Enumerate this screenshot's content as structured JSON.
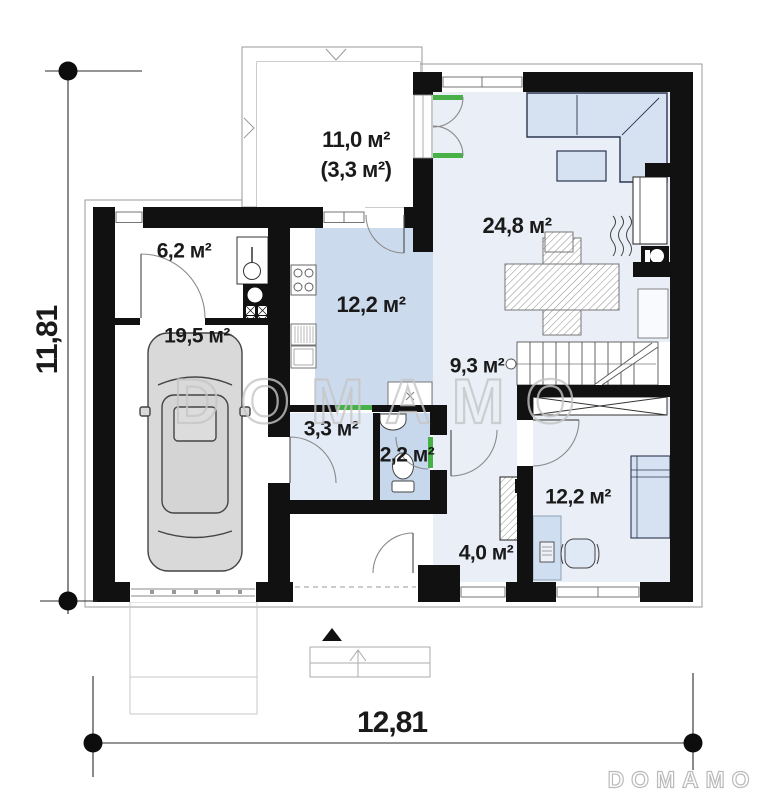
{
  "rooms": [
    {
      "id": "terrace",
      "area_label": "11,0 м²",
      "area_label_secondary": "(3,3 м²)"
    },
    {
      "id": "boiler-room",
      "area_label": "6,2 м²"
    },
    {
      "id": "garage",
      "area_label": "19,5 м²"
    },
    {
      "id": "kitchen",
      "area_label": "12,2 м²"
    },
    {
      "id": "living-room",
      "area_label": "24,8 м²"
    },
    {
      "id": "hallway",
      "area_label": "9,3 м²"
    },
    {
      "id": "mudroom",
      "area_label": "3,3 м²"
    },
    {
      "id": "wc",
      "area_label": "2,2 м²"
    },
    {
      "id": "utility",
      "area_label": "4,0 м²"
    },
    {
      "id": "bedroom",
      "area_label": "12,2 м²"
    }
  ],
  "dimensions": {
    "height_label": "11,81",
    "width_label": "12,81"
  },
  "watermark": {
    "center": "DOMAMO",
    "corner": "DOMAMO"
  },
  "symbols": [
    "chimney",
    "slope-arrow",
    "terrace-outline",
    "entrance-arrow",
    "porch-steps",
    "driveway",
    "car",
    "corner-sofa",
    "coffee-table",
    "dining-table",
    "fireplace",
    "stairs",
    "wardrobe",
    "bed",
    "desk",
    "desk-chair",
    "toilet",
    "sink",
    "washing-machine",
    "boiler",
    "water-heater",
    "cooktop",
    "kitchen-counter",
    "window",
    "door-swing",
    "dimension-marker"
  ],
  "colors": {
    "wall": "#111111",
    "room-floor": "#e9eef7",
    "kitchen-floor": "#ccdaed",
    "wc-floor": "#c7d7ec",
    "mudroom-floor": "#e3ebf6",
    "furniture-fill": "#d6e2f2",
    "door-accent": "#47b147",
    "watermark-gray": "#c6c6c6",
    "dimension-ink": "#1a1a1a"
  }
}
